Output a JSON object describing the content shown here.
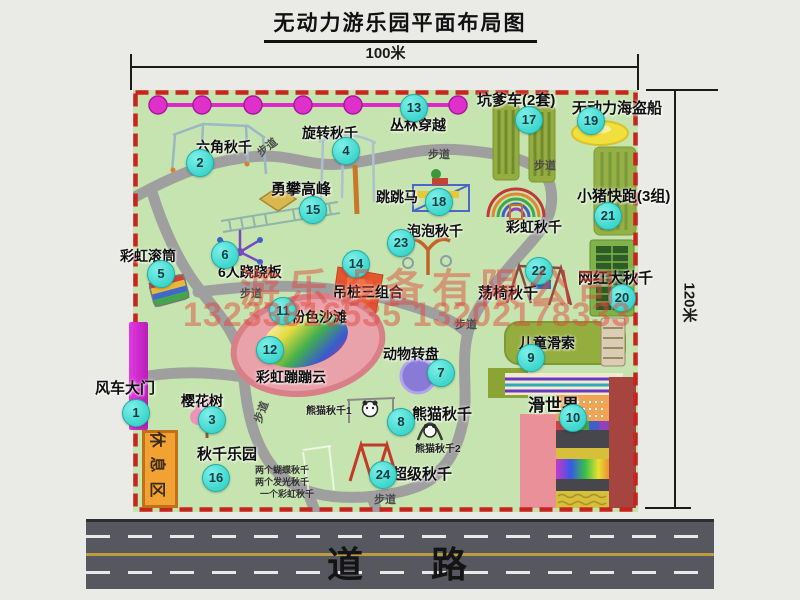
{
  "title": "无动力游乐园平面布局图",
  "dim_width": "100米",
  "dim_height": "120米",
  "road_label": "道 路",
  "trail_label": "步道",
  "rest_area": "休息区",
  "rainbow_swing": "彩虹秋千",
  "watermark": {
    "company": "游乐设备有限公司",
    "phone": "13233816535 13202178333"
  },
  "colors": {
    "map_green": "#c6e4af",
    "border_red": "#c9231f",
    "badge_cyan": "#3ed6cd",
    "gate_magenta": "#cf28d4",
    "rest_orange": "#f2a233",
    "road_gray": "#57575f",
    "watermark_red": "#e0483a"
  },
  "attractions": [
    {
      "num": "1",
      "name": "风车大门"
    },
    {
      "num": "2",
      "name": "六角秋千"
    },
    {
      "num": "3",
      "name": "樱花树"
    },
    {
      "num": "4",
      "name": "旋转秋千"
    },
    {
      "num": "5",
      "name": "彩虹滚筒"
    },
    {
      "num": "6",
      "name": "6人跷跷板"
    },
    {
      "num": "7",
      "name": "动物转盘"
    },
    {
      "num": "8",
      "name": "熊猫秋千",
      "sub1": "熊猫秋千1",
      "sub2": "熊猫秋千2"
    },
    {
      "num": "9",
      "name": "儿童滑索"
    },
    {
      "num": "10",
      "name": "滑世界"
    },
    {
      "num": "11",
      "name": "粉色沙滩"
    },
    {
      "num": "12",
      "name": "彩虹蹦蹦云"
    },
    {
      "num": "13",
      "name": "丛林穿越"
    },
    {
      "num": "14",
      "name": "吊桩三组合"
    },
    {
      "num": "15",
      "name": "勇攀高峰"
    },
    {
      "num": "16",
      "name": "秋千乐园",
      "notes": [
        "两个蝴蝶秋千",
        "两个发光秋千",
        "一个彩虹秋千"
      ]
    },
    {
      "num": "17",
      "name": "坑爹车(2套)"
    },
    {
      "num": "18",
      "name": "跳跳马"
    },
    {
      "num": "19",
      "name": "无动力海盗船"
    },
    {
      "num": "20",
      "name": "网红大秋千"
    },
    {
      "num": "21",
      "name": "小猪快跑(3组)"
    },
    {
      "num": "22",
      "name": "荡椅秋千"
    },
    {
      "num": "23",
      "name": "泡泡秋千"
    },
    {
      "num": "24",
      "name": "超级秋千"
    }
  ]
}
